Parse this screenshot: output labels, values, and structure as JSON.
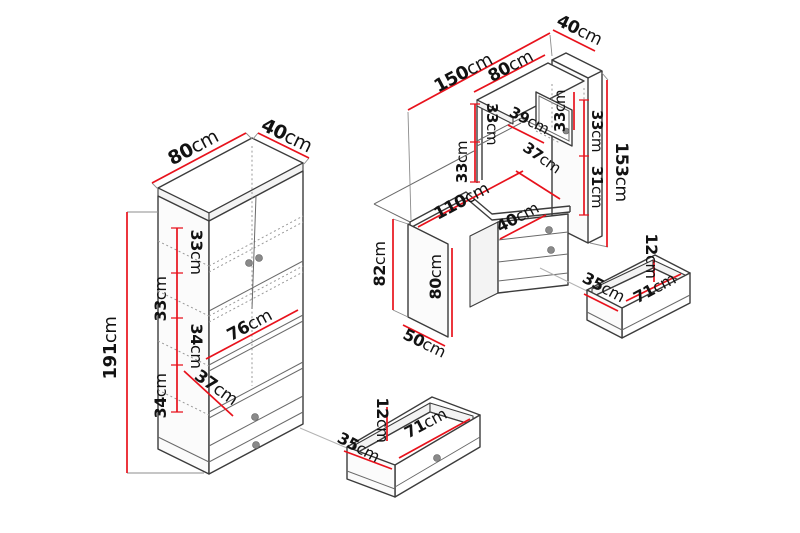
{
  "meta": {
    "background": "#ffffff",
    "dimension_line_color": "#e8121c",
    "outline_color": "#3c3c3c",
    "unit": "cm"
  },
  "cabinet": {
    "name": "tall bookcase with doors and drawers",
    "dims": {
      "width": "80cm",
      "depth": "40cm",
      "height": "191cm",
      "section_1": "33cm",
      "section_2": "33cm",
      "section_3": "34cm",
      "section_4": "34cm",
      "shelf_width": "76cm",
      "shelf_depth": "37cm"
    }
  },
  "desk": {
    "name": "corner desk with hutch and drawer pedestal",
    "dims": {
      "total_width": "150cm",
      "back_panel_depth": "40cm",
      "hutch_width": "80cm",
      "hutch_left_upper": "33cm",
      "hutch_shelf": "39cm",
      "mirror_height": "33cm",
      "hutch_left_lower": "33cm",
      "desktop_depth": "37cm",
      "right_upper": "33cm",
      "right_lower": "31cm",
      "total_height": "153cm",
      "desktop_width": "110cm",
      "side_panel_outer": "82cm",
      "side_panel_inner": "80cm",
      "side_panel_depth": "50cm",
      "pedestal_width": "40cm"
    }
  },
  "drawer_detail_left": {
    "name": "bookcase drawer detail",
    "dims": {
      "height": "12cm",
      "depth": "35cm",
      "width": "71cm"
    }
  },
  "drawer_detail_right": {
    "name": "desk drawer detail",
    "dims": {
      "height": "12cm",
      "depth": "35cm",
      "width": "71cm"
    }
  }
}
